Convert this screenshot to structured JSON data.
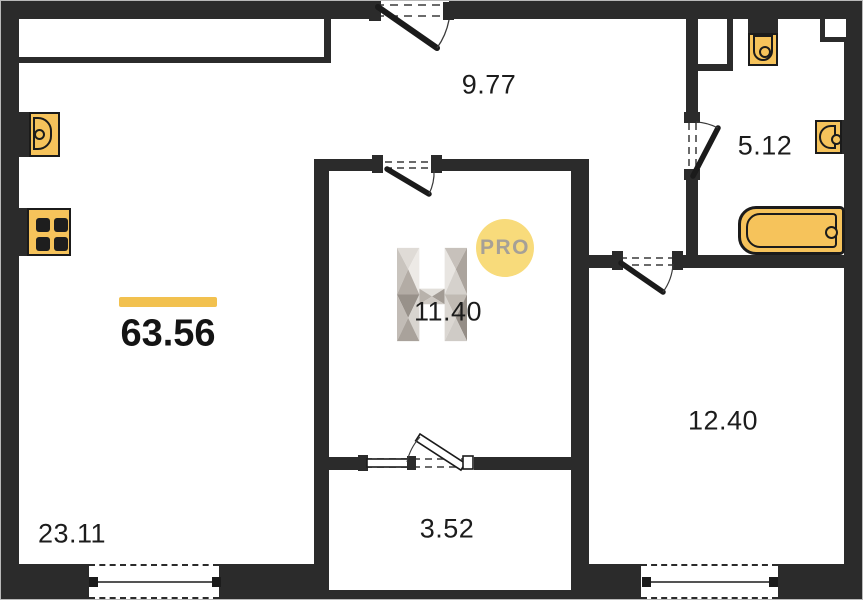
{
  "plan": {
    "title": "apartment-floor-plan",
    "total_area": "63.56",
    "rooms": [
      {
        "name": "living-kitchen",
        "area": "23.11"
      },
      {
        "name": "hallway",
        "area": "9.77"
      },
      {
        "name": "bathroom",
        "area": "5.12"
      },
      {
        "name": "room-center",
        "area": "11.40"
      },
      {
        "name": "room-right",
        "area": "12.40"
      },
      {
        "name": "closet",
        "area": "3.52"
      }
    ],
    "watermark": {
      "letter": "H",
      "badge": "PRO"
    },
    "fixtures": [
      "kitchen-sink",
      "stove",
      "toilet",
      "washbasin",
      "bathtub"
    ],
    "colors": {
      "wall": "#2B2B2B",
      "fixture_fill": "#F6C35B",
      "accent_bar": "#F2C14F",
      "badge_bg": "#F8DB7B",
      "badge_text": "#A6A097",
      "background": "#FFFFFF"
    }
  }
}
